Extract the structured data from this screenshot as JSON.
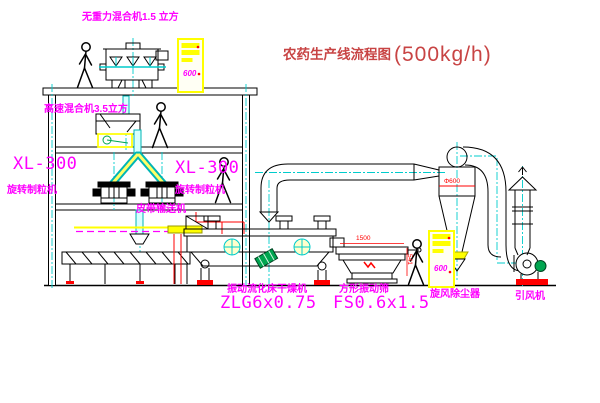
{
  "title": {
    "main": "农药生产线流程图",
    "capacity": "(500kg/h)"
  },
  "equipment_labels": {
    "top_mixer": "无重力混合机1.5 立方",
    "mid_mixer": "高速混合机3.5立方",
    "granulator_left": {
      "model": "XL-300",
      "name": "旋转制粒机"
    },
    "granulator_right": {
      "model": "XL-300",
      "name": "旋转制粒机"
    },
    "belt_conveyor": "皮带输送机",
    "dryer": {
      "name": "振动流化床干燥机",
      "model": "ZLG6x0.75"
    },
    "screen": {
      "name": "方形振动筛",
      "model": "FS0.6x1.5"
    },
    "cyclone": "旋风除尘器",
    "fan": "引风机"
  },
  "dimension_labels": {
    "cyclone_diameter": "Φ600",
    "screen_length": "1500",
    "screen_height": "541"
  },
  "control_cabinets": {
    "top_cabinet_text": "600",
    "right_cabinet_text": "600"
  },
  "colors": {
    "label_magenta": "#FF00FF",
    "title_red": "#C84444",
    "line_black": "#000000",
    "centerline_cyan": "#00CCCC",
    "cabinet_yellow": "#FFFF00",
    "accent_red": "#FF0000",
    "motor_green": "#00A550"
  }
}
